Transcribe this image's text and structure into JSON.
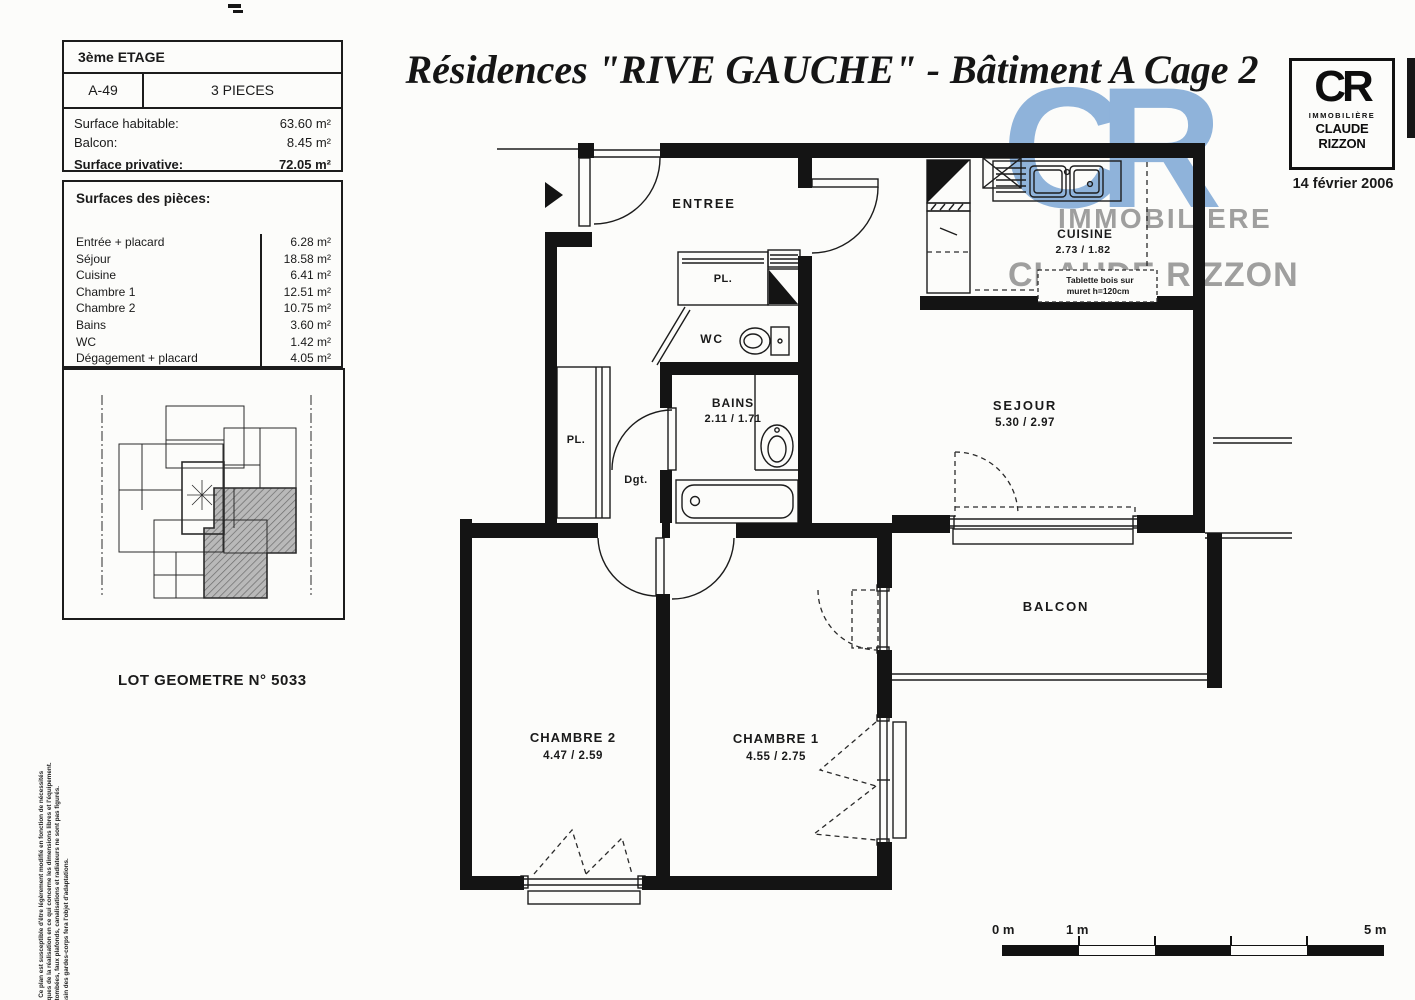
{
  "header": {
    "title": "Résidences \"RIVE GAUCHE\" - Bâtiment A Cage 2",
    "date": "14 février 2006"
  },
  "logo": {
    "cr": "CR",
    "line1": "IMMOBILIÈRE",
    "line2": "CLAUDE RIZZON"
  },
  "watermark": {
    "cr": "CR",
    "line1": "IMMOBILIERE",
    "line2": "CLAUDE RIZZON",
    "blue": "#86add8",
    "gray": "#8f8f8f"
  },
  "info_box": {
    "floor": "3ème ETAGE",
    "lot": "A-49",
    "type": "3 PIECES",
    "rows": [
      {
        "label": "Surface habitable:",
        "value": "63.60 m²"
      },
      {
        "label": "Balcon:",
        "value": "8.45 m²"
      },
      {
        "label": "Surface privative:",
        "value": "72.05 m²"
      }
    ]
  },
  "surfaces_box": {
    "title": "Surfaces des pièces:",
    "rows": [
      {
        "label": "Entrée + placard",
        "value": "6.28 m²"
      },
      {
        "label": "Séjour",
        "value": "18.58 m²"
      },
      {
        "label": "Cuisine",
        "value": "6.41 m²"
      },
      {
        "label": "Chambre 1",
        "value": "12.51 m²"
      },
      {
        "label": "Chambre 2",
        "value": "10.75 m²"
      },
      {
        "label": "Bains",
        "value": "3.60 m²"
      },
      {
        "label": "WC",
        "value": "1.42 m²"
      },
      {
        "label": "Dégagement + placard",
        "value": "4.05 m²"
      }
    ]
  },
  "lot_label": "LOT GEOMETRE N° 5033",
  "plan": {
    "entree": "ENTREE",
    "cuisine": {
      "name": "CUISINE",
      "dims": "2.73 / 1.82"
    },
    "sejour": {
      "name": "SEJOUR",
      "dims": "5.30 / 2.97"
    },
    "balcon": "BALCON",
    "chambre1": {
      "name": "CHAMBRE 1",
      "dims": "4.55 / 2.75"
    },
    "chambre2": {
      "name": "CHAMBRE 2",
      "dims": "4.47 / 2.59"
    },
    "bains": {
      "name": "BAINS",
      "dims": "2.11 / 1.71"
    },
    "wc": "WC",
    "pl_entree": "PL.",
    "pl_degagement": "PL.",
    "degagement": "Dgt.",
    "note": {
      "line1": "Tablette bois sur",
      "line2": "muret h=120cm"
    }
  },
  "scale_bar": {
    "m0": "0 m",
    "m1": "1 m",
    "m5": "5 m"
  },
  "disclaimer": {
    "lines": [
      "NOTA: Ce plan est susceptible d'être légèrement modifié en fonction de nécessités",
      "techniques de la réalisation en ce qui concerne les dimensions libres et l'équipement.",
      "Les retombées, faux plafonds, canalisations et radiateurs ne sont pas figurés.",
      "Le dessin des gardes-corps fera l'objet d'adaptations."
    ]
  }
}
